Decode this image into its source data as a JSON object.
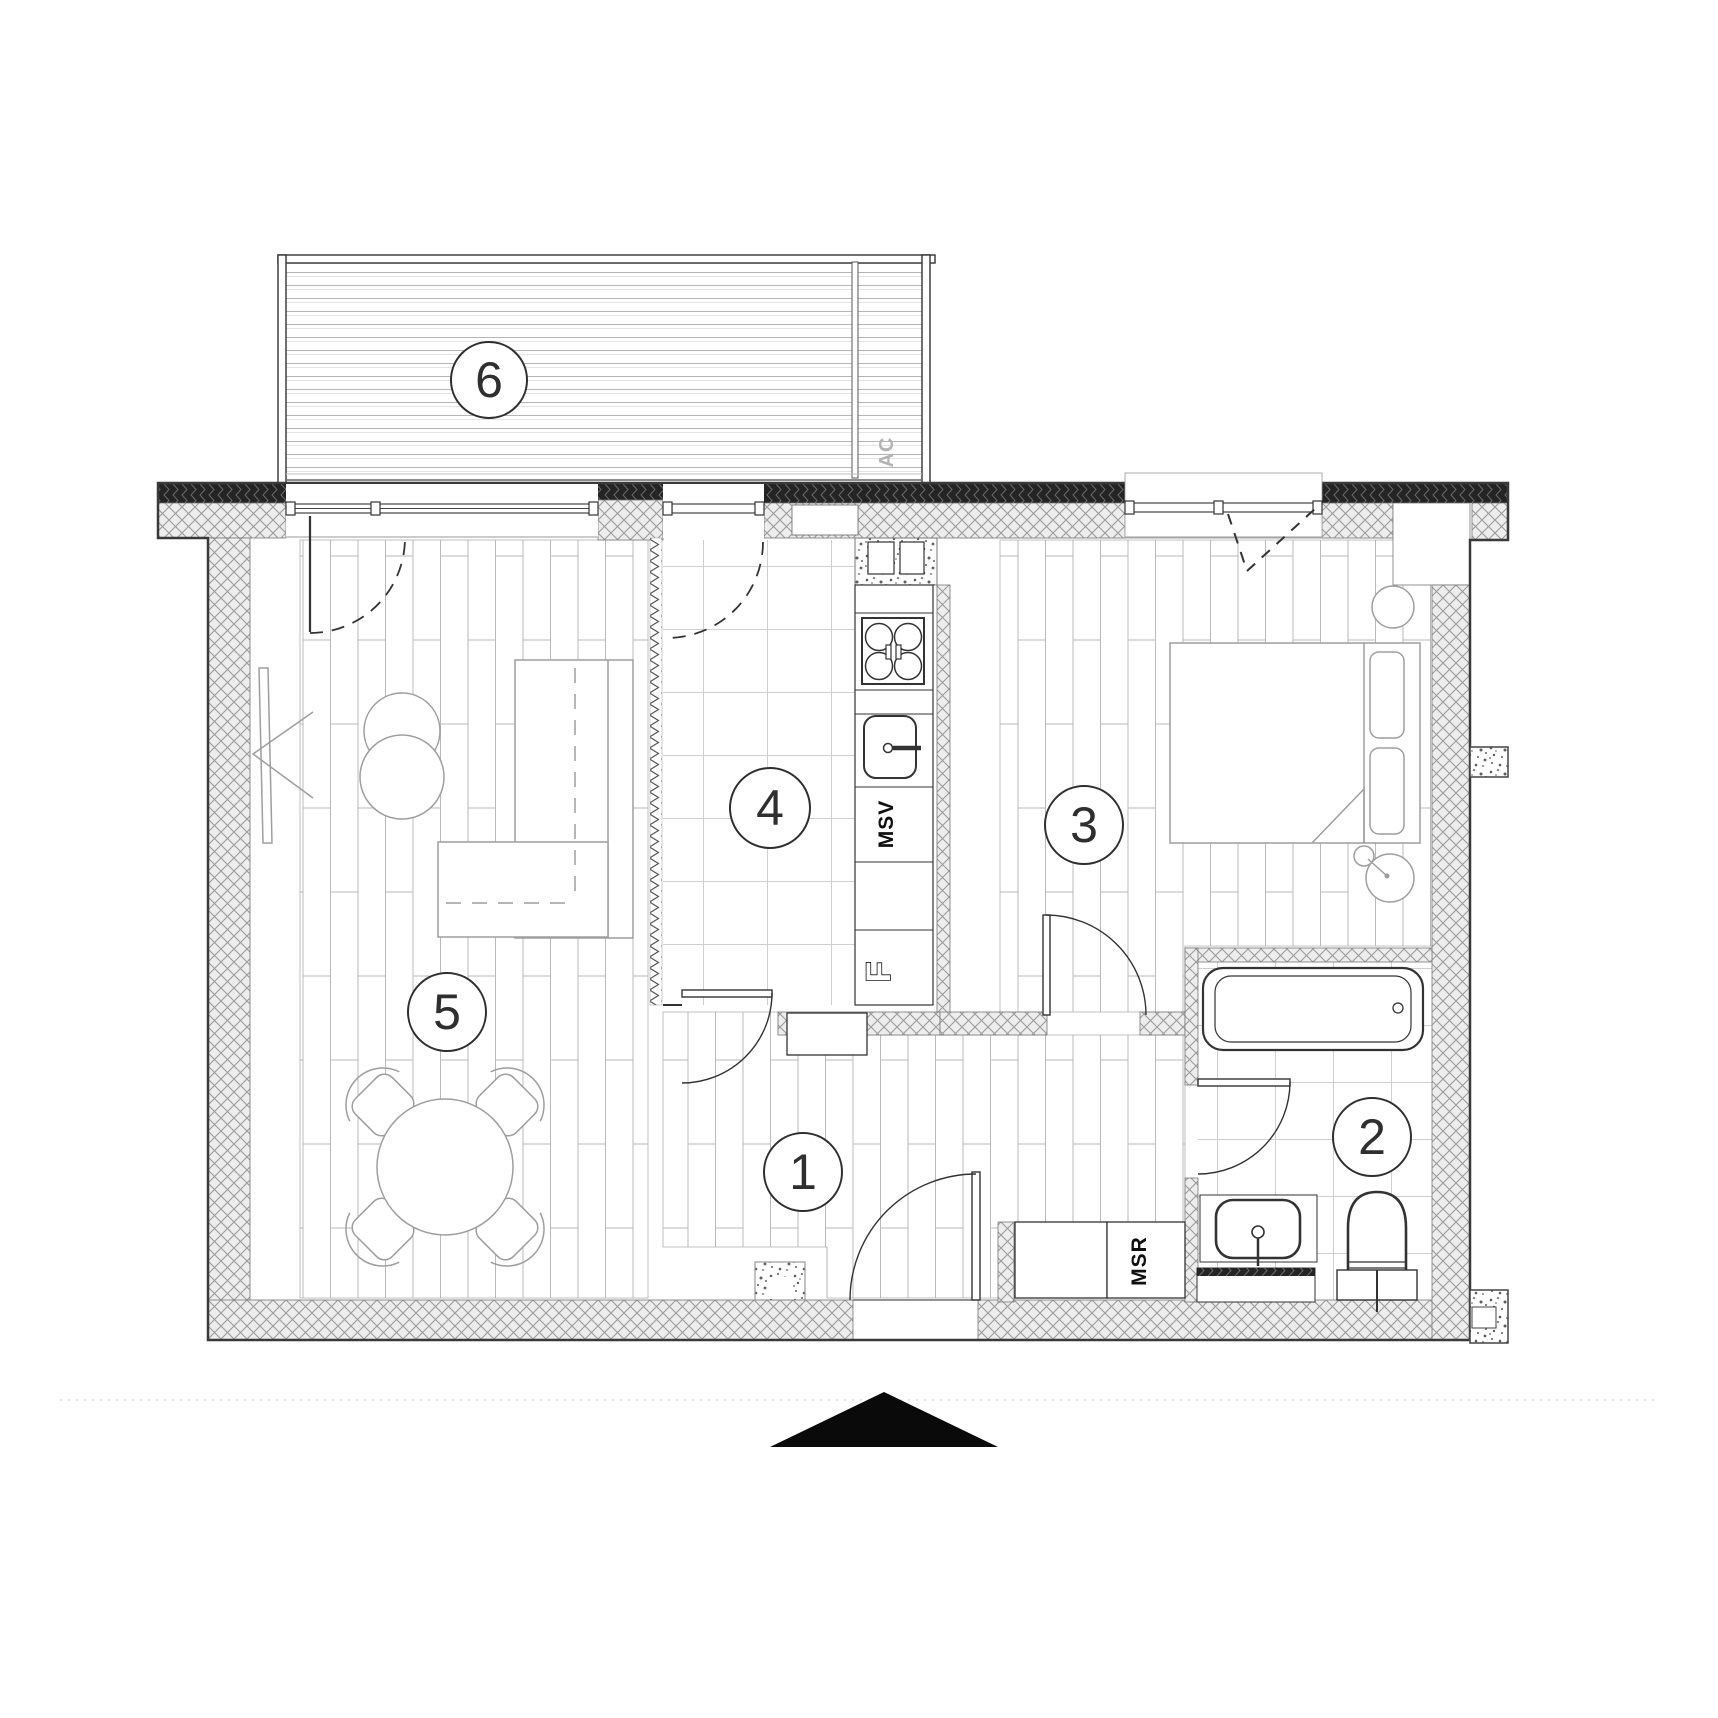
{
  "plan": {
    "rooms": [
      {
        "number": "1",
        "name": "hallway"
      },
      {
        "number": "2",
        "name": "bathroom"
      },
      {
        "number": "3",
        "name": "bedroom"
      },
      {
        "number": "4",
        "name": "kitchen"
      },
      {
        "number": "5",
        "name": "living-room"
      },
      {
        "number": "6",
        "name": "balcony"
      }
    ],
    "labels": {
      "ac": "AC",
      "msv": "MSV",
      "msr": "MSR",
      "fridge": "F"
    },
    "colors": {
      "wall_line": "#333333",
      "wall_fill": "#ededed",
      "dark_band": "#242424",
      "furniture_line": "#9e9e9e",
      "floor_line": "#c9c9c9",
      "north_arrow": "#0a0a0a"
    }
  }
}
